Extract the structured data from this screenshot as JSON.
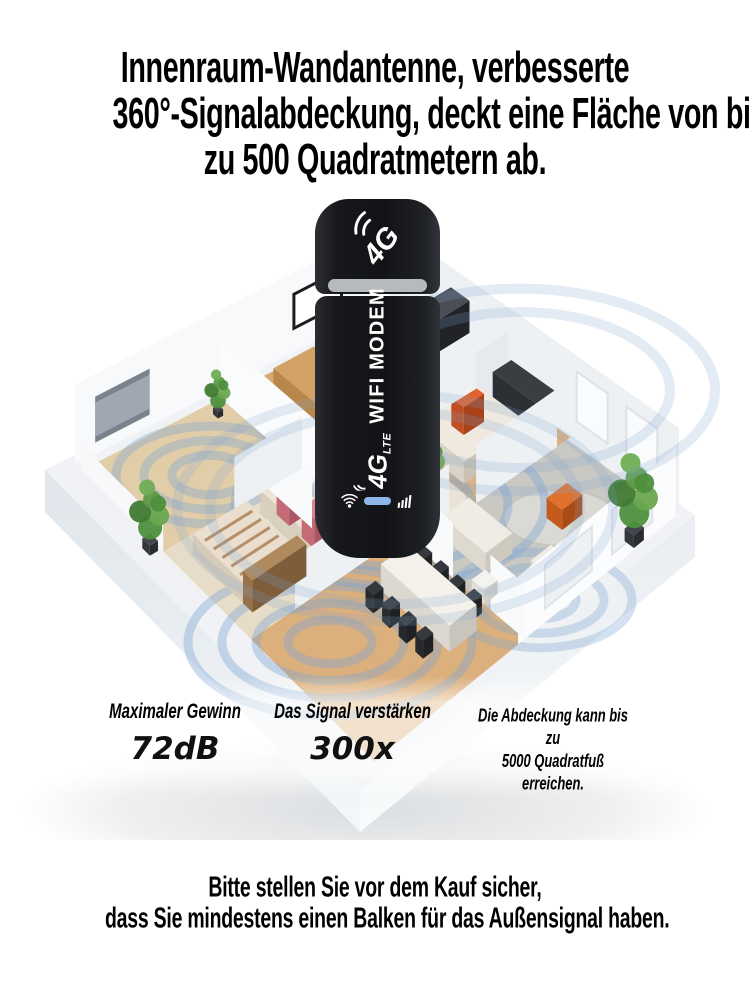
{
  "headline": {
    "line1": "Innenraum-Wandantenne, verbesserte",
    "line2": "360°-Signalabdeckung, deckt eine Fläche von bis",
    "line3": "zu 500 Quadratmetern ab."
  },
  "device": {
    "logo": "4G",
    "logo_sub": "LTE",
    "body_text": "WIFI MODEM",
    "indicators": [
      "wifi-icon",
      "led-bar",
      "signal-bars-icon"
    ]
  },
  "stats": [
    {
      "label": "Maximaler Gewinn",
      "value": "72dB"
    },
    {
      "label": "Das Signal verstärken",
      "value": "300x"
    },
    {
      "label": "Die Abdeckung kann bis zu\n5000 Quadratfuß\nerreichen.",
      "value": ""
    }
  ],
  "footer": {
    "line1": "Bitte stellen Sie vor dem Kauf sicher,",
    "line2": "dass Sie mindestens einen Balken für das Außensignal haben."
  },
  "colors": {
    "signal_ring": "#7ea6d3",
    "led_blue": "#8cb7e8",
    "device_black": "#17181c",
    "cap_band_gray": "#b6b9be",
    "text_black": "#000000"
  }
}
